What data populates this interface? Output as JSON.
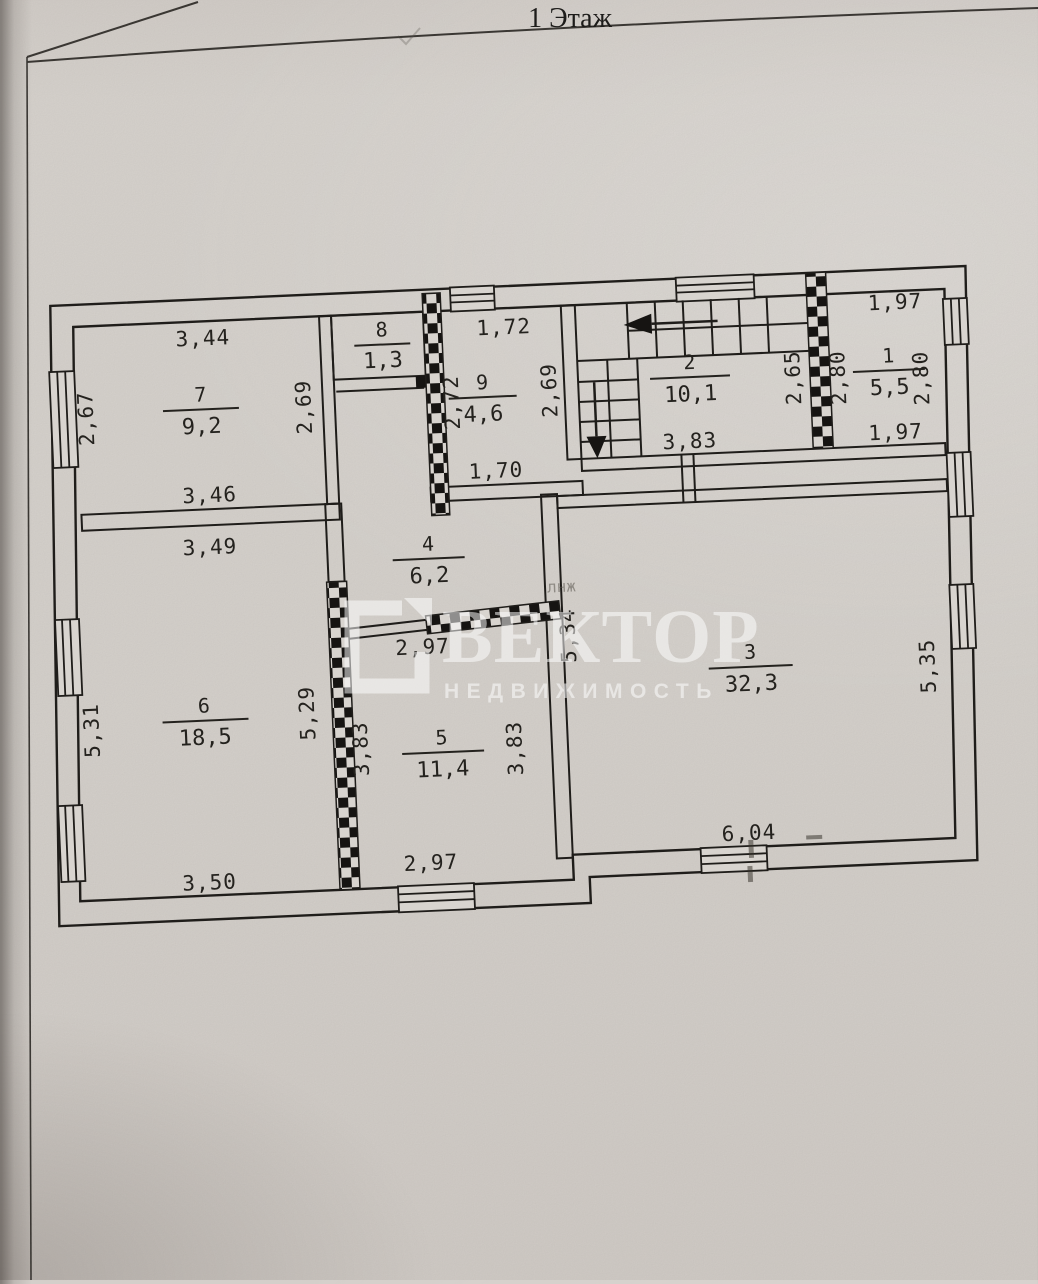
{
  "page": {
    "title": "1 Этаж",
    "watermark": {
      "brand": "ВЕКТОР",
      "subtitle": "НЕДВИЖИМОСТЬ"
    },
    "faint_note": "лнж"
  },
  "rooms": {
    "1": {
      "number": "1",
      "area": "5,5"
    },
    "2": {
      "number": "2",
      "area": "10,1"
    },
    "3": {
      "number": "3",
      "area": "32,3"
    },
    "4": {
      "number": "4",
      "area": "6,2"
    },
    "5": {
      "number": "5",
      "area": "11,4"
    },
    "6": {
      "number": "6",
      "area": "18,5"
    },
    "7": {
      "number": "7",
      "area": "9,2"
    },
    "8": {
      "number": "8",
      "area": "1,3"
    },
    "9": {
      "number": "9",
      "area": "4,6"
    }
  },
  "dims": {
    "r7_top": "3,44",
    "r7_left": "2,67",
    "r7_right": "2,69",
    "r7_bottom": "3,46",
    "r9_top": "1,72",
    "r9_left": "2,72",
    "r9_right": "2,69",
    "r9_bottom": "1,70",
    "r2_bottom": "3,83",
    "r2_right": "2,65",
    "r1_top": "1,97",
    "r1_left": "2,80",
    "r1_right": "2,80",
    "r1_bottom": "1,97",
    "r4_bottom": "2,97",
    "r6_top": "3,49",
    "r6_left": "5,31",
    "r6_right": "5,29",
    "r6_bottom": "3,50",
    "r5_left": "3,83",
    "r5_right": "3,83",
    "r5_bottom": "2,97",
    "r3_left": "5,34",
    "r3_right": "5,35",
    "r3_bottom": "6,04"
  }
}
